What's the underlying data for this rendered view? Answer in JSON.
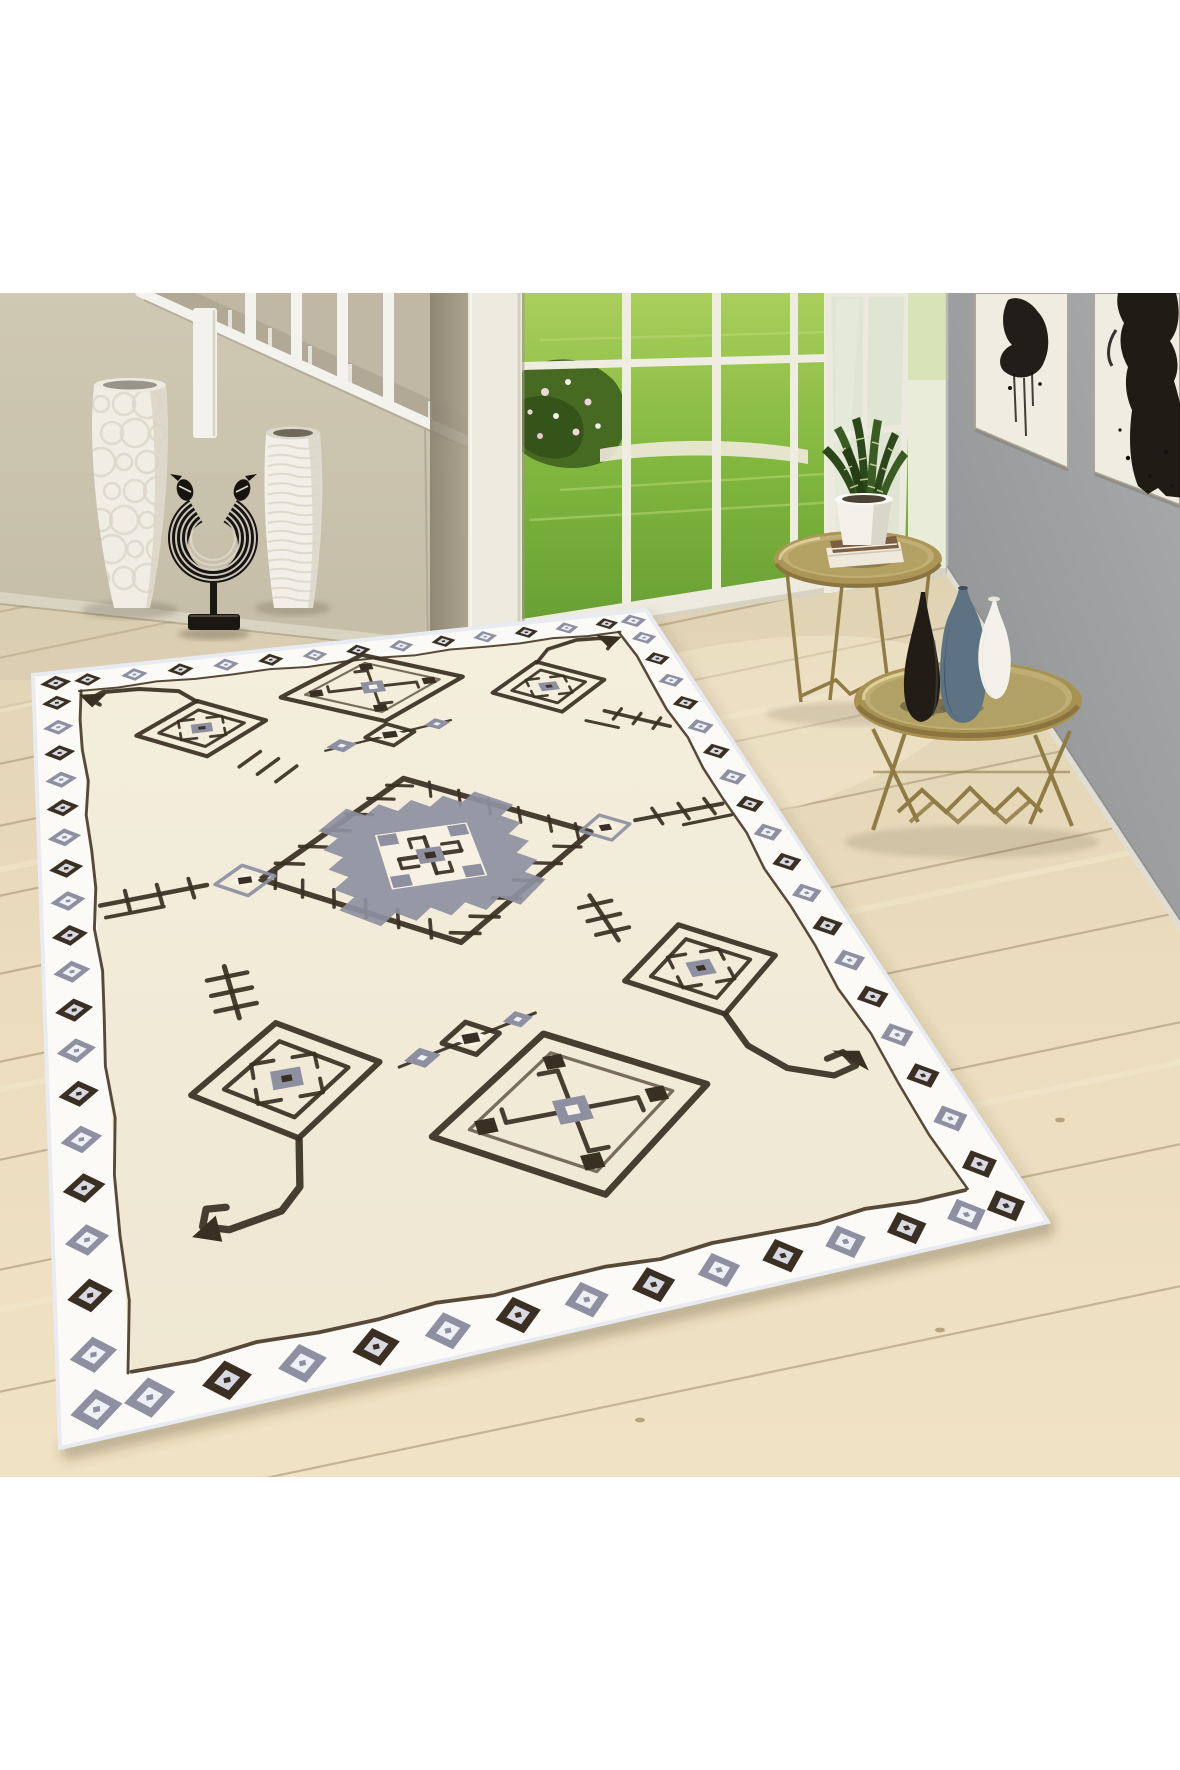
{
  "meta": {
    "kind": "product-photo",
    "description": "Cream Berber-style tribal area rug staged in a bright hallway: white staircase balusters on a beige wall, open french doors to a sunny garden, gray gallery wall with two black-ink artworks, light oak plank floor, two white floor vases with a zebra-striped crescent sculpture, and two round gold tray side tables holding a snake plant, books and three bottle vases.",
    "canvas": {
      "width": 1180,
      "height": 1770
    },
    "photo_area": {
      "top": 293,
      "bottom": 1477
    }
  },
  "palette": {
    "white_band": "#ffffff",
    "wall_beige_1": "#cfc8b3",
    "wall_beige_2": "#c3bba4",
    "stair_zone": "#c0b8a4",
    "stair_strip": "#b1a995",
    "stair_white": "#f3f2ec",
    "sliver_1": "#867e6b",
    "sliver_2": "#a89f8b",
    "frame_white": "#edebe0",
    "grass_1": "#aace5c",
    "grass_2": "#7fb63e",
    "grass_3": "#68a034",
    "bush": "#476a23",
    "bush_dark": "#35541a",
    "flower_1": "#eed5da",
    "flower_2": "#f5efe8",
    "path_white": "#efeadb",
    "terrace": "#edebdf",
    "sill": "#d8d2c2",
    "glass_pale": "#dfe5d2",
    "gray_wall_1": "#a9abad",
    "gray_wall_2": "#8e9092",
    "canvas": "#efece1",
    "ink": "#16120d",
    "wood_1": "#e0d3b4",
    "wood_2": "#eadcbc",
    "wood_3": "#f0e3c4",
    "wood_line": "#b2a180",
    "wood_streak": "#f4ebd2",
    "baseboard": "#d9d3c2",
    "rug_band": "#fbfaf6",
    "rug_field_1": "#f4eedd",
    "rug_field_2": "#efe7d2",
    "rug_dark": "#3a2f23",
    "rug_gray": "#8e90a1",
    "rug_inner_line": "#4a3c2a",
    "selvage": "#e8ebf2",
    "gold_1": "#ab9557",
    "gold_2": "#c0ae72",
    "gold_3": "#b3a164",
    "gold_dark": "#8a7540",
    "gold_leg": "#8f7b44",
    "vase_black": "#211c16",
    "vase_blue": "#5d7383",
    "vase_blue_dark": "#46596a",
    "vase_white": "#f3f1ea",
    "plant_dark": "#2c4719",
    "plant_mid": "#3a5c22",
    "plant_light": "#cfdba6",
    "pot_white": "#f2f0e9",
    "shadow": "#3c3222"
  },
  "scene": {
    "wall_left": {
      "label": "beige hallway wall with staircase"
    },
    "staircase": {
      "balusters": 4,
      "newel_posts": 1,
      "color": "white"
    },
    "garden_door": {
      "label": "open french doors to sunny garden",
      "mullions": 3,
      "open_leaf": true
    },
    "wall_right": {
      "label": "gray gallery wall",
      "artworks": [
        {
          "label": "abstract ink figure"
        },
        {
          "label": "abstract ink dress"
        }
      ]
    },
    "floor": {
      "label": "light oak plank floor"
    },
    "decor_left": [
      {
        "label": "white pebble-textured floor vase"
      },
      {
        "label": "zebra-striped crescent sculpture on black stand"
      },
      {
        "label": "white ribbed floor vase"
      }
    ],
    "side_tables": [
      {
        "label": "gold tray table with snake plant and books"
      },
      {
        "label": "gold tray table with black, blue and white bottle vases"
      }
    ],
    "rug": {
      "label": "cream Berber tribal rug with dark hand-drawn motifs",
      "corners_px": [
        [
          33,
          675
        ],
        [
          646,
          610
        ],
        [
          1048,
          1222
        ],
        [
          60,
          1448
        ]
      ],
      "size_units": [
        700,
        1000
      ],
      "band_inset": 46,
      "border": "diamond chain on ivory band",
      "motifs": [
        "arrow-staff greek-key diamond (top-left)",
        "cross diamond (top-center)",
        "three-diamond chain (upper)",
        "arrow-staff greek-key diamond (top-right)",
        "central ticked diamond with serrated gray medallion",
        "comb with gray diamond (left)",
        "gray diamond with comb (right)",
        "greek-key diamond with comb and hooked staff (bottom-left)",
        "cross diamond (bottom-center)",
        "three-diamond chain (lower)",
        "greek-key diamond with comb and hooked staff (right)"
      ]
    }
  }
}
